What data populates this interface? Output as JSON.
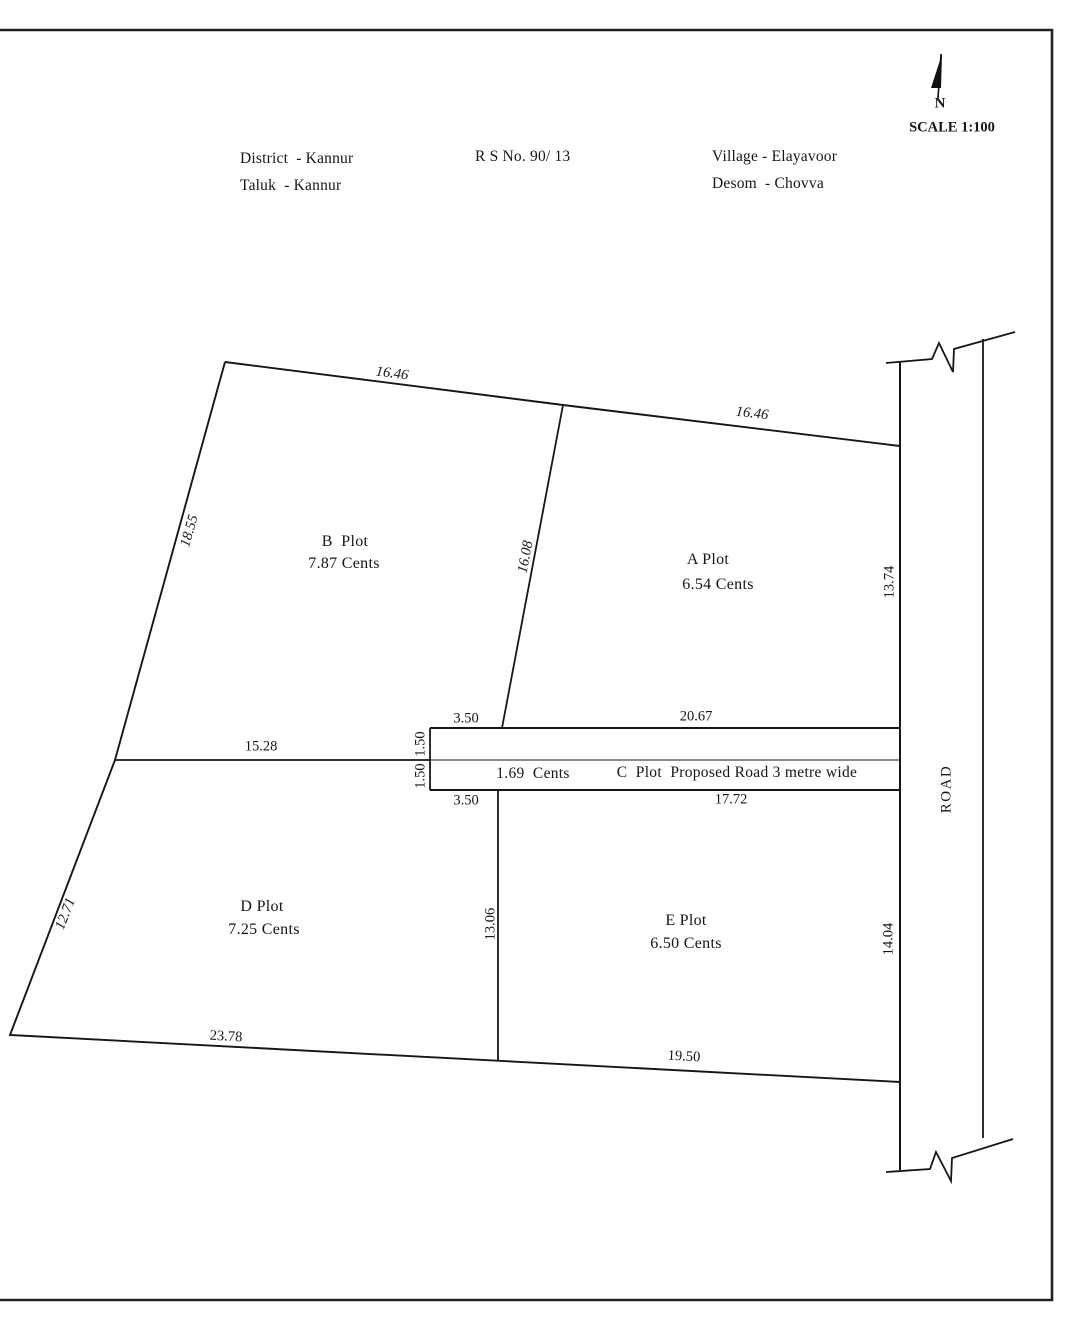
{
  "title_block": {
    "district": "District  - Kannur",
    "taluk": "Taluk  - Kannur",
    "rs_no": "R S No. 90/ 13",
    "village": "Village - Elayavoor",
    "desom": "Desom  - Chovva"
  },
  "compass": {
    "north_label": "N",
    "scale_label": "SCALE 1:100"
  },
  "road_label": "ROAD",
  "plots": {
    "a": {
      "name": "A Plot",
      "area": "6.54 Cents"
    },
    "b": {
      "name": "B  Plot",
      "area": "7.87 Cents"
    },
    "c": {
      "area": "1.69  Cents",
      "description": "C  Plot  Proposed Road 3 metre wide"
    },
    "d": {
      "name": "D Plot",
      "area": "7.25 Cents"
    },
    "e": {
      "name": "E Plot",
      "area": "6.50 Cents"
    }
  },
  "dimensions": {
    "b_top_edge": "16.46",
    "a_top_edge": "16.46",
    "west_upper_edge": "18.55",
    "ba_divider": "16.08",
    "a_right_edge": "13.74",
    "strip_top_left": "3.50",
    "strip_top_right": "20.67",
    "strip_upper_width": "1.50",
    "strip_lower_width": "1.50",
    "bd_boundary": "15.28",
    "strip_bottom_left": "3.50",
    "strip_bottom_right": "17.72",
    "west_lower_edge": "12.71",
    "de_divider": "13.06",
    "e_right_edge": "14.04",
    "d_bottom_edge": "23.78",
    "e_bottom_edge": "19.50"
  },
  "colors": {
    "ink": "#161616",
    "paper": "#ffffff"
  }
}
